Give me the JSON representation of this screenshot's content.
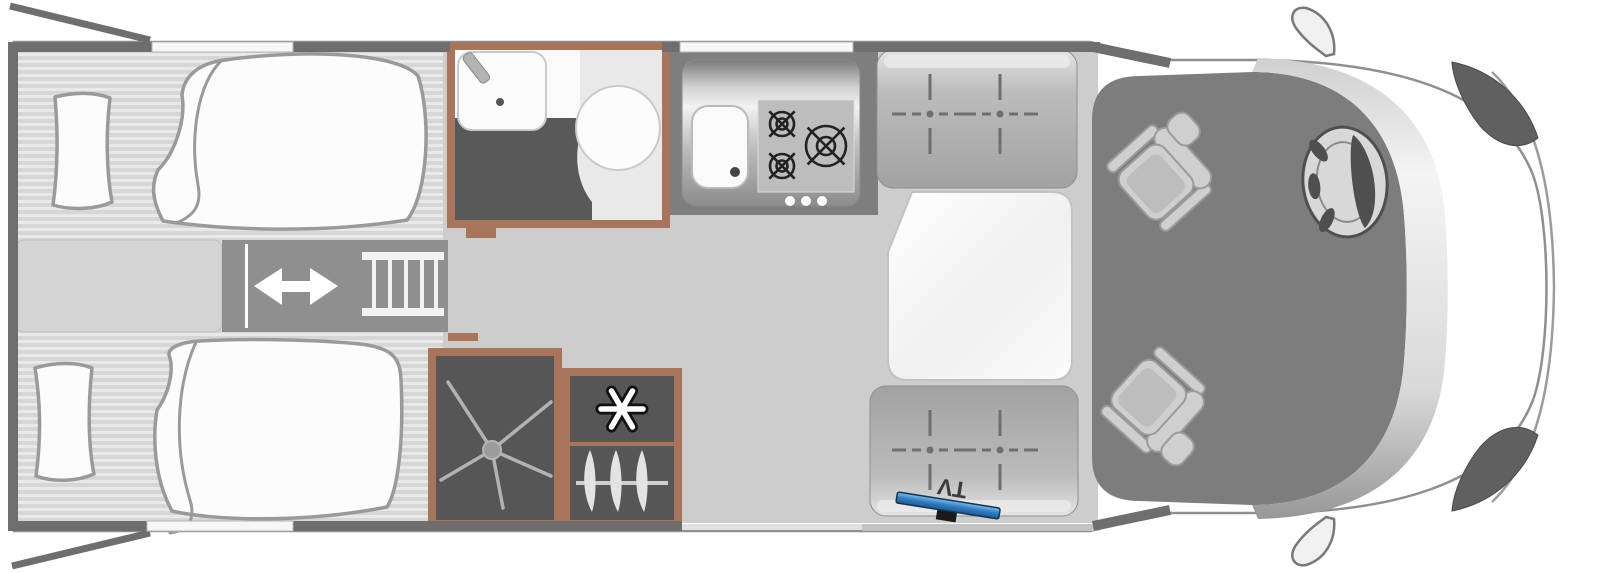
{
  "meta": {
    "type": "motorhome-floorplan",
    "view": "top-down"
  },
  "labels": {
    "tv": "TV"
  },
  "colors": {
    "background": "#ffffff",
    "wall": "#6e6e6e",
    "body_outline": "#8f8f8f",
    "bed_stripe_dark": "#d6d6d6",
    "bed_stripe_light": "#e9e9e9",
    "bedding_fill": "#fcfcfc",
    "bedding_outline": "#9a9a9a",
    "wood": "#a8745c",
    "dark_unit": "#565656",
    "bath_floor_dark": "#595959",
    "corridor": "#cdcdcd",
    "kitchen_surround": "#7e7e7e",
    "cab_floor": "#7d7d7d",
    "slide_dark": "#8f8f8f",
    "burner": "#222222",
    "seat_fill": "#cfcfcf",
    "seat_stroke": "#9b9b9b",
    "headlight": "#606060",
    "tv_blue": "#2f7cc0",
    "tv_edge": "#16344d"
  },
  "fixtures": [
    "rear-twin-bed-top",
    "rear-twin-bed-bottom",
    "bed-pillows",
    "center-cabinet",
    "sliding-step",
    "bed-ladder",
    "washbasin",
    "toilet",
    "shower-tray",
    "fridge-freezer",
    "wardrobe",
    "kitchen-sink",
    "hob-3-burner",
    "dinette-bench-front",
    "dinette-bench-rear",
    "dinette-table",
    "tv-bracket",
    "cab-swivel-seat-driver",
    "cab-swivel-seat-passenger",
    "steering-wheel",
    "door-mirror-top",
    "door-mirror-bottom",
    "rear-garage-door-flaps"
  ]
}
